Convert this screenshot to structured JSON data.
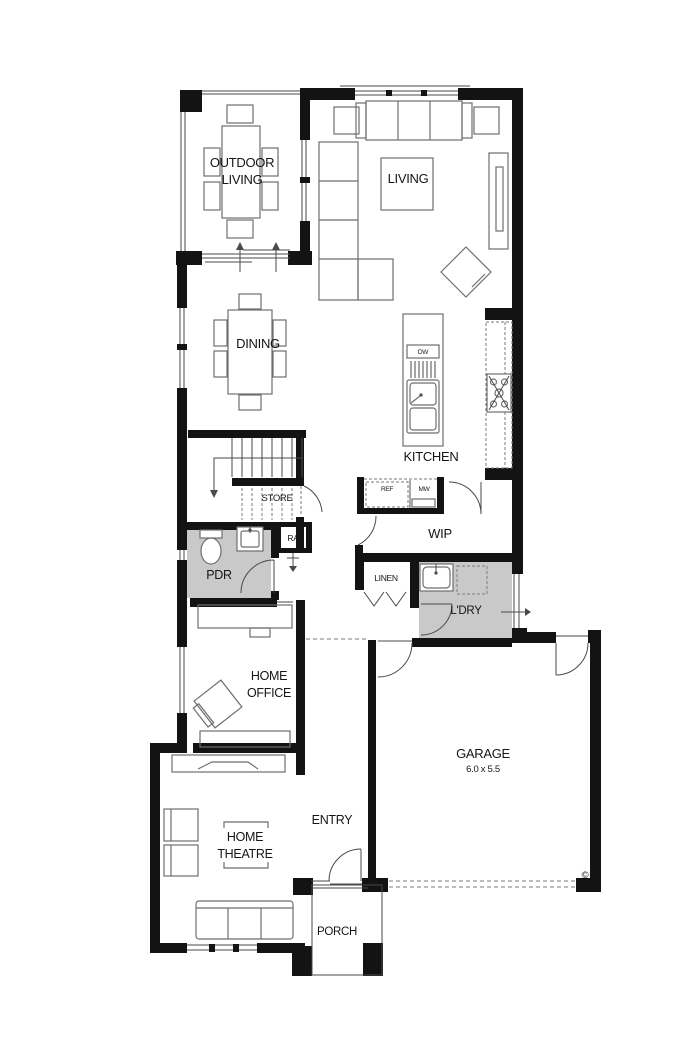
{
  "plan_type": "floor-plan",
  "rooms": {
    "outdoor_living": {
      "name_line1": "OUTDOOR",
      "name_line2": "LIVING"
    },
    "living": {
      "name": "LIVING"
    },
    "dining": {
      "name": "DINING"
    },
    "kitchen": {
      "name": "KITCHEN",
      "dishwasher": "DW"
    },
    "stairs": {
      "store": "STORE"
    },
    "powder_room": {
      "name": "PDR",
      "return_air": "RA"
    },
    "pantry": {
      "name": "WIP",
      "fridge": "REF",
      "microwave": "MW"
    },
    "linen": {
      "name": "LINEN"
    },
    "laundry": {
      "name": "L'DRY"
    },
    "home_office": {
      "name_line1": "HOME",
      "name_line2": "OFFICE"
    },
    "entry": {
      "name": "ENTRY"
    },
    "garage": {
      "name": "GARAGE",
      "dimensions": "6.0 x 5.5",
      "copyright_mark": "©"
    },
    "home_theatre": {
      "name_line1": "HOME",
      "name_line2": "THEATRE"
    },
    "porch": {
      "name": "PORCH"
    }
  },
  "colors": {
    "wall": "#131313",
    "line": "#4a4a4a",
    "furniture": "#6e6e6e",
    "dash": "#7a7a7a",
    "wet_floor": "#c9c9c9",
    "background": "#ffffff"
  }
}
